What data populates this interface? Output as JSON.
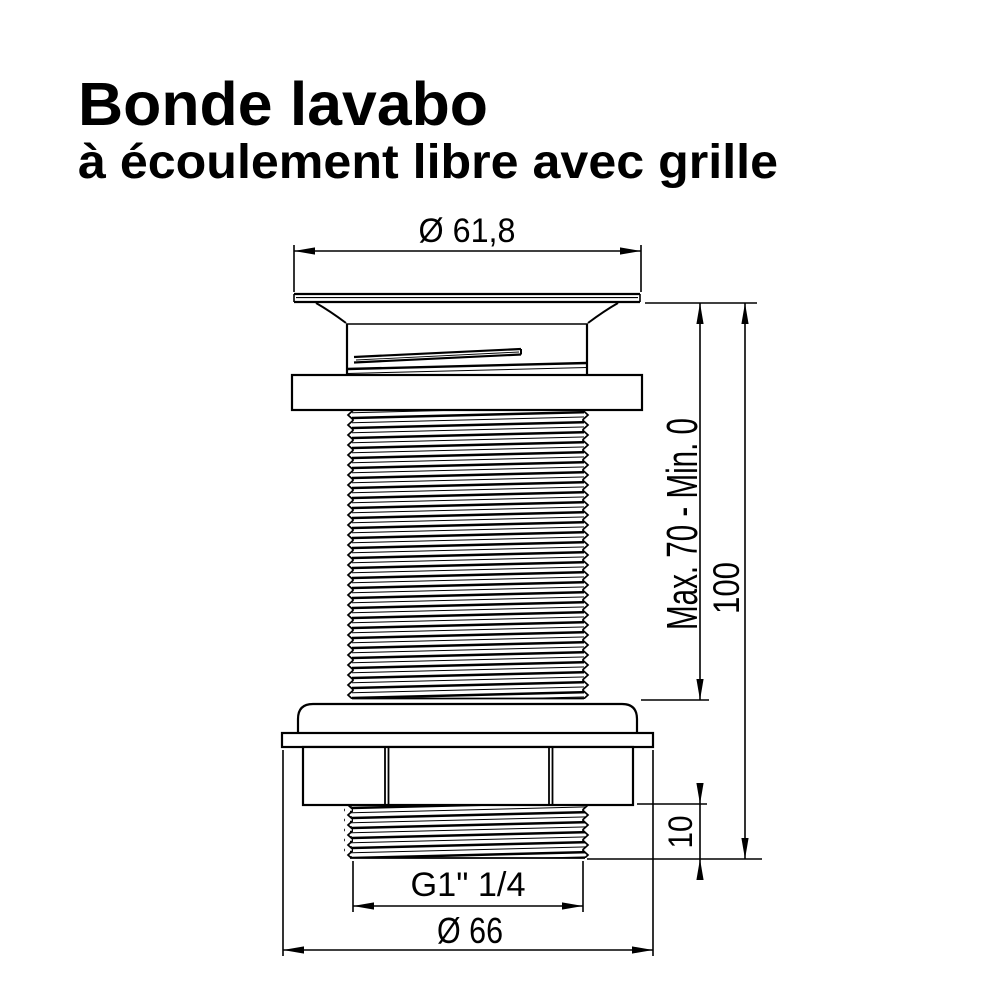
{
  "title": {
    "line1": "Bonde lavabo",
    "line2": "à écoulement libre avec grille"
  },
  "drawing": {
    "subject": "free-flow basin waste with grid, technical side view",
    "dimensions": {
      "top_flange_diameter": "Ø 61,8",
      "clamping_range": "Max. 70 - Min. 0",
      "total_height": "100",
      "exposed_thread_height": "10",
      "thread_size": "G1\" 1/4",
      "bottom_flange_diameter": "Ø 66"
    }
  },
  "colors": {
    "line": "#000000",
    "background": "#ffffff"
  }
}
